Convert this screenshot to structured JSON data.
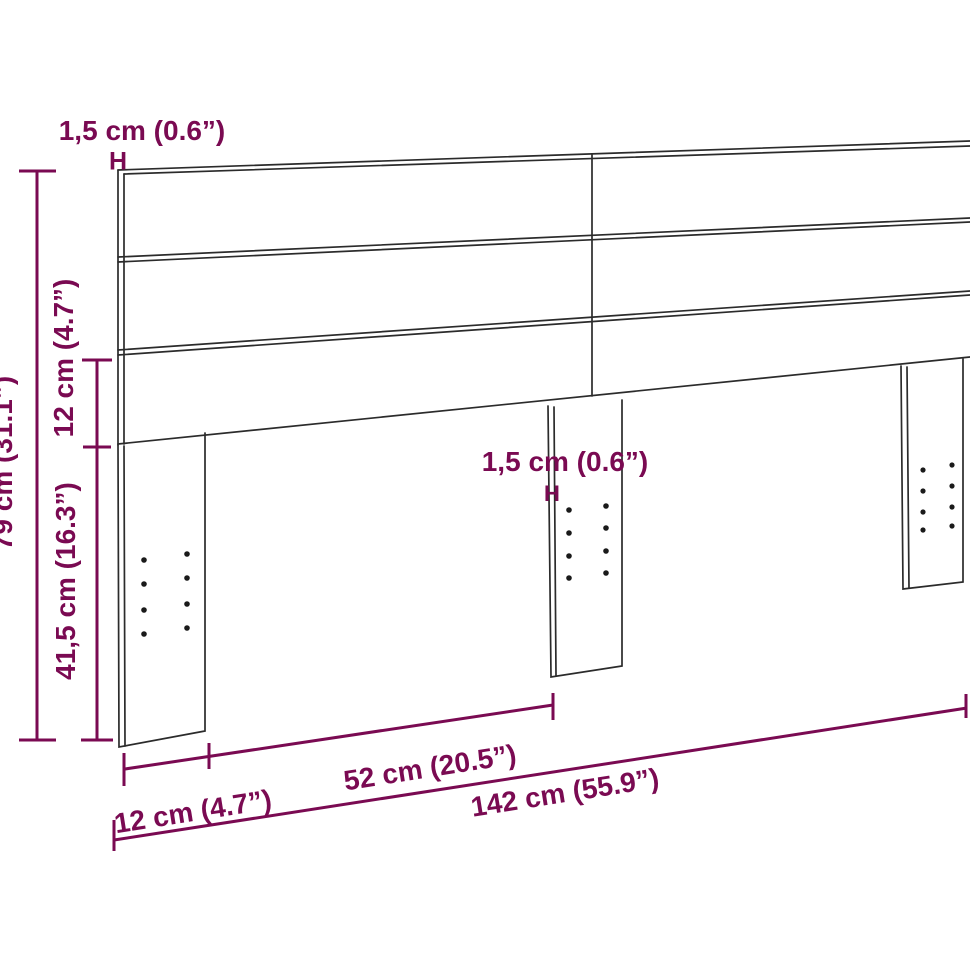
{
  "page": {
    "description": "Technical dimension drawing of a slatted wooden headboard with three support legs, shown in slight perspective",
    "background": "#ffffff"
  },
  "colors": {
    "dimension_accent": "#7a0a52",
    "outline": "#2b2b2b",
    "hole_dots": "#1a1a1a"
  },
  "labels": {
    "top_thickness": "1,5 cm (0.6”)",
    "top_thickness_marker": "H",
    "total_height": "79 cm (31.1”)",
    "bottom_slat_height": "12 cm (4.7”)",
    "leg_height": "41,5 cm (16.3”)",
    "middle_thickness": "1,5 cm (0.6”)",
    "middle_thickness_marker": "H",
    "leg_inset_width": "12 cm (4.7”)",
    "leg_spacing_width": "52 cm (20.5”)",
    "total_width": "142 cm (55.9”)"
  },
  "measurements": [
    {
      "name": "board thickness (top)",
      "metric": "1,5 cm",
      "imperial": "0.6”"
    },
    {
      "name": "total height",
      "metric": "79 cm",
      "imperial": "31.1”"
    },
    {
      "name": "bottom slat height",
      "metric": "12 cm",
      "imperial": "4.7”"
    },
    {
      "name": "leg height",
      "metric": "41,5 cm",
      "imperial": "16.3”"
    },
    {
      "name": "leg thickness (middle)",
      "metric": "1,5 cm",
      "imperial": "0.6”"
    },
    {
      "name": "leg inset from side",
      "metric": "12 cm",
      "imperial": "4.7”"
    },
    {
      "name": "leg spacing",
      "metric": "52 cm",
      "imperial": "20.5”"
    },
    {
      "name": "total width",
      "metric": "142 cm",
      "imperial": "55.9”"
    }
  ]
}
